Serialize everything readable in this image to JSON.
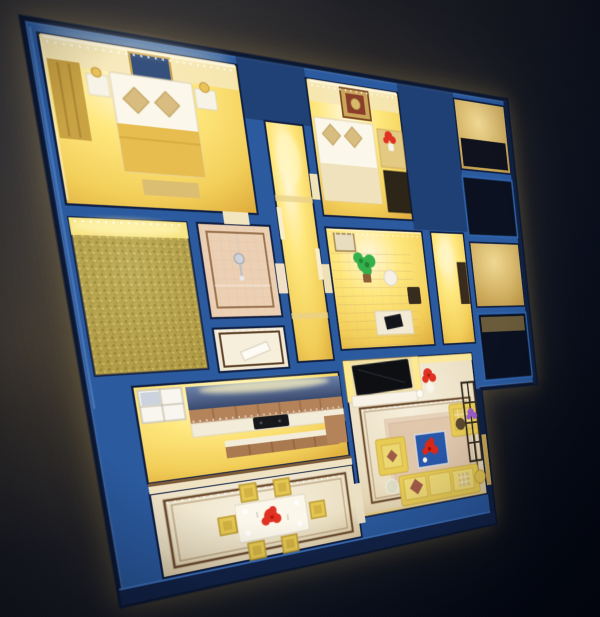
{
  "scene": {
    "type": "photograph",
    "subject": "illuminated architectural scale model of an apartment floor plan viewed from above at an oblique angle",
    "style": "royal-blue wall tops, warm yellow LED interior lighting, dark charcoal-to-navy background",
    "environment": {
      "background": "dark speckled surface top-left fading to deep navy bottom-right",
      "lighting": "warm white-yellow LED strips glowing inside every room"
    },
    "rooms": [
      {
        "id": "master-bedroom",
        "position": "top-left",
        "items": [
          "double bed with gold blanket",
          "two tan diamond pillows",
          "framed wall art",
          "white nightstands",
          "gold table lamps",
          "gold wardrobe",
          "LED ceiling strip"
        ]
      },
      {
        "id": "carpeted-bedroom",
        "position": "mid-left",
        "items": [
          "olive shag carpet",
          "bright LED cove lighting"
        ]
      },
      {
        "id": "bathroom",
        "position": "center",
        "items": [
          "hanging chrome shower fixture",
          "peach tile floor",
          "dark floor inlay border"
        ]
      },
      {
        "id": "foyer",
        "position": "center",
        "items": [
          "white open door",
          "marble floor with dark inlay"
        ]
      },
      {
        "id": "hallway",
        "position": "center",
        "items": [
          "glowing yellow walls",
          "door openings with lintels"
        ]
      },
      {
        "id": "bedroom-2",
        "position": "top-center",
        "items": [
          "ornate gold medallion artwork",
          "bed with two pillows",
          "red flowers in white vase",
          "dark wardrobe"
        ]
      },
      {
        "id": "study",
        "position": "center-right",
        "items": [
          "green potted plant",
          "white round table",
          "black laptop on white seat",
          "dark chair",
          "wood plank floor",
          "framed art"
        ]
      },
      {
        "id": "entry-hall",
        "position": "right",
        "items": [
          "dark entry door"
        ]
      },
      {
        "id": "kitchen",
        "position": "mid-left",
        "items": [
          "slate-blue backsplash",
          "wood upper cabinets",
          "white counter",
          "black cooktop",
          "wood island",
          "window"
        ]
      },
      {
        "id": "living-room",
        "position": "bottom-right",
        "items": [
          "wall-mounted black TV",
          "white media console",
          "red flowers in white vase",
          "round white ball lamp",
          "blue coffee table with red roses",
          "yellow three-seat sofa with patterned cushions",
          "yellow armchairs",
          "metal display shelf with purple flowers",
          "yellow rope pouf",
          "glass side table",
          "beige area rug",
          "marble floor with brown inlay border and LED dots"
        ]
      },
      {
        "id": "dining-room",
        "position": "bottom-left",
        "items": [
          "white dining table",
          "red rose centerpiece",
          "white plates",
          "six yellow woven chairs",
          "marble floor with double inlay border and LED dots",
          "white half wall to kitchen"
        ]
      },
      {
        "id": "balconies",
        "position": "right-edge",
        "items": [
          "blue framed dark window voids",
          "dimly lit ledges"
        ]
      }
    ]
  },
  "colors": {
    "wall_blue": "#2b5a9e",
    "wall_blue_dark": "#14264d",
    "wall_rim_dark": "#0c1831",
    "wall_highlight": "#5b8ed6",
    "room_hot": "#fff8dc",
    "room_bright": "#ffe87e",
    "room_mid": "#f3cf5a",
    "room_deep": "#dfae3e",
    "dim_light": "#f0d893",
    "dim_deep": "#bb9440",
    "marble_light": "#f7f0de",
    "marble_mid": "#ebdfc2",
    "marble_deep": "#d9c49a",
    "carpet_olive": "#a89a42",
    "backsplash_top": "#6d81a9",
    "backsplash_bottom": "#394a6f",
    "cabinet_wood": "#b5835a",
    "sofa_yellow": "#e7cb55",
    "linen_white": "#fbf7ea",
    "flower_red": "#e03222",
    "plant_green": "#35b04a",
    "flower_purple": "#9a5cc8",
    "tv_black": "#0e0f13",
    "coffee_table_blue": "#2a58a8",
    "inlay_brown": "#6e4e30",
    "led_white": "#fff8e0",
    "bath_tile": "#ecd0b4",
    "blanket_gold": "#e8bd4f",
    "background_dark": "#1d1e24",
    "background_navy": "#04070f"
  }
}
